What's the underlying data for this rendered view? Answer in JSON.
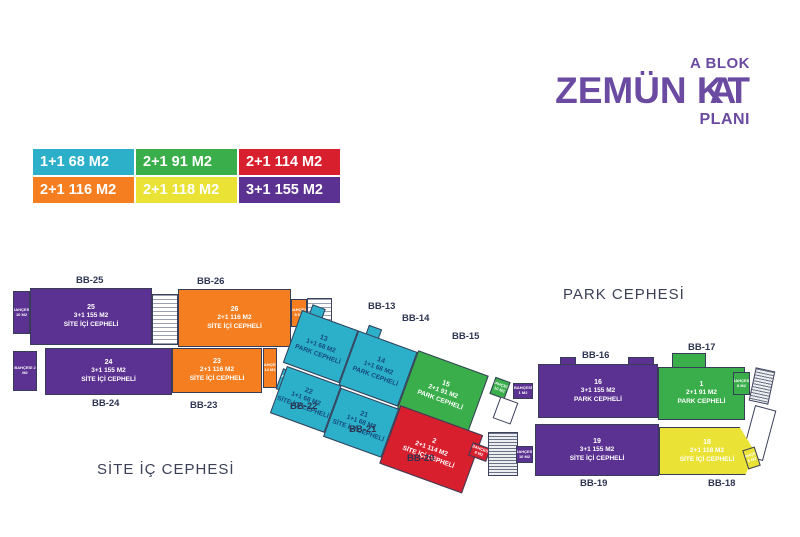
{
  "title": {
    "block": "A BLOK",
    "big_part1": "ZEMÜN K",
    "big_part2": "A",
    "big_part3": "T",
    "sub": "PLANI"
  },
  "palette": {
    "cyan": "#2cb0c9",
    "green": "#3aae4a",
    "red": "#d71f2e",
    "orange": "#f57e20",
    "yellow": "#eae234",
    "purple": "#5b3191",
    "title_text": "#6b4aa2",
    "label_text": "#2e3552"
  },
  "legend": [
    {
      "label": "1+1 68 M2",
      "color_key": "cyan"
    },
    {
      "label": "2+1 91 M2",
      "color_key": "green"
    },
    {
      "label": "2+1 114 M2",
      "color_key": "red"
    },
    {
      "label": "2+1 116 M2",
      "color_key": "orange"
    },
    {
      "label": "2+1 118 M2",
      "color_key": "yellow"
    },
    {
      "label": "3+1 155 M2",
      "color_key": "purple"
    }
  ],
  "facade_labels": {
    "park": "PARK CEPHESİ",
    "site": "SİTE İÇ CEPHESİ"
  },
  "units": [
    {
      "bb": "BB-25",
      "number": "25",
      "size": "3+1 155 M2",
      "facade": "SİTE İÇİ CEPHELİ",
      "type": "purple"
    },
    {
      "bb": "BB-26",
      "number": "26",
      "size": "2+1 116 M2",
      "facade": "SİTE İÇİ CEPHELİ",
      "type": "orange"
    },
    {
      "bb": "BB-24",
      "number": "24",
      "size": "3+1 155 M2",
      "facade": "SİTE İÇİ CEPHELİ",
      "type": "purple"
    },
    {
      "bb": "BB-23",
      "number": "23",
      "size": "2+1 116 M2",
      "facade": "SİTE İÇİ CEPHELİ",
      "type": "orange"
    },
    {
      "bb": "BB-13",
      "number": "13",
      "size": "1+1 68 M2",
      "facade": "PARK CEPHELİ",
      "type": "cyan"
    },
    {
      "bb": "BB-14",
      "number": "14",
      "size": "1+1 68 M2",
      "facade": "PARK CEPHELİ",
      "type": "cyan"
    },
    {
      "bb": "BB-15",
      "number": "15",
      "size": "2+1 91 M2",
      "facade": "PARK CEPHELİ",
      "type": "green"
    },
    {
      "bb": "BB-22",
      "number": "22",
      "size": "1+1 68 M2",
      "facade": "SİTE İÇİ CEPHELİ",
      "type": "cyan"
    },
    {
      "bb": "BB-21",
      "number": "21",
      "size": "1+1 68 M2",
      "facade": "SİTE İÇİ CEPHELİ",
      "type": "cyan"
    },
    {
      "bb": "BB-20",
      "number": "2",
      "size": "2+1 114 M2",
      "facade": "SİTE İÇİ CEPHELİ",
      "type": "red"
    },
    {
      "bb": "BB-16",
      "number": "16",
      "size": "3+1 155 M2",
      "facade": "PARK CEPHELİ",
      "type": "purple"
    },
    {
      "bb": "BB-17",
      "number": "1",
      "size": "2+1 91 M2",
      "facade": "PARK CEPHELİ",
      "type": "green"
    },
    {
      "bb": "BB-19",
      "number": "19",
      "size": "3+1 155 M2",
      "facade": "SİTE İÇİ CEPHELİ",
      "type": "purple"
    },
    {
      "bb": "BB-18",
      "number": "18",
      "size": "2+1 118 M2",
      "facade": "SİTE İÇİ CEPHELİ",
      "type": "yellow"
    }
  ],
  "tags": [
    {
      "label": "BAHÇESİ 10 M2"
    },
    {
      "label": "BAHÇESİ 2 M2"
    },
    {
      "label": "BAHÇESİ 8 M2"
    },
    {
      "label": "BAHÇESİ 14 M2"
    },
    {
      "label": "BAHÇESİ 4 M2"
    },
    {
      "label": "BAHÇESİ 10 M2"
    },
    {
      "label": "BAHÇESİ 1 M2"
    },
    {
      "label": "BAHÇESİ 8 M2"
    },
    {
      "label": "BAHÇESİ 10 M2"
    },
    {
      "label": "BAHÇESİ 8 M2"
    },
    {
      "label": "BAHÇESİ 6 M2"
    }
  ]
}
